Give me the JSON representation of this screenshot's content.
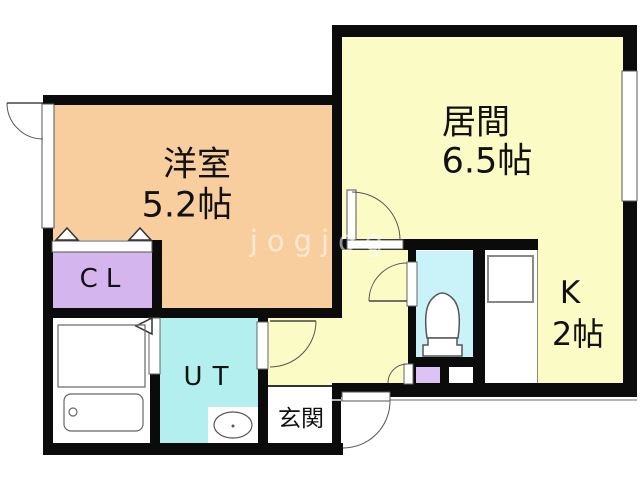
{
  "title": "1DK apartment floor plan",
  "rooms": {
    "yoshitsu": {
      "name": "洋室",
      "size": "5.2帖"
    },
    "ima": {
      "name": "居間",
      "size": "6.5帖"
    },
    "kitchen": {
      "name": "K",
      "size": "2帖"
    },
    "closet": {
      "label": "CL"
    },
    "utility": {
      "label": "UT"
    },
    "genkan": {
      "label": "玄関"
    }
  },
  "watermark": {
    "text": "jogjog"
  },
  "colors": {
    "wall": "#0b0b0b",
    "yoshitsu": "#f9ce9e",
    "living": "#fbfbc6",
    "closet": "#d4b5ed",
    "storage": "#dcc3f3",
    "utility": "#b2efee",
    "toilet": "#c9f3f9",
    "fixture_line": "#555555"
  }
}
